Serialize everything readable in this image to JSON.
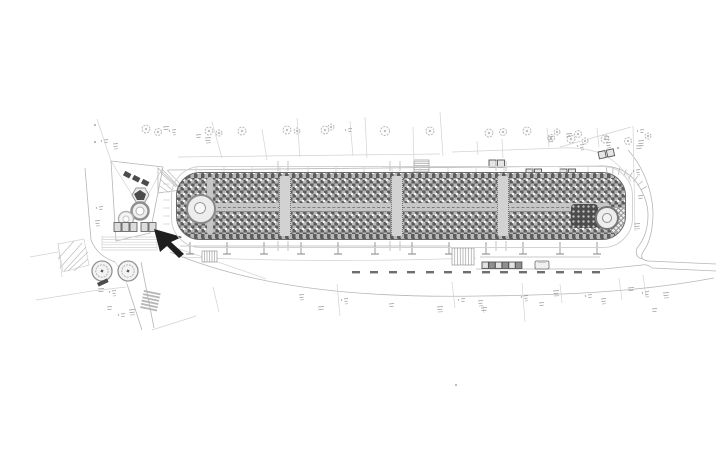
{
  "canvas": {
    "width": 718,
    "height": 450
  },
  "colors": {
    "paper": "#ffffff",
    "faint": "#d2d2d2",
    "line": "#b6b6b6",
    "mid": "#989898",
    "ink": "#6e6e6e",
    "dark": "#4c4c4c",
    "black": "#1f1f1f",
    "fill_light": "#f3f3f3",
    "prom_dark": "#5c5c5c",
    "prom_light": "#b9b9b9",
    "prom_dot": "#f4f4f4",
    "strip_light": "#d2d2d2",
    "band": "#c6c6c6"
  },
  "plan": {
    "promenade": {
      "x": 176,
      "y": 172,
      "w": 450,
      "h": 68,
      "radius": 24,
      "crosswalk_xs": [
        283,
        395,
        501
      ]
    },
    "posts": {
      "y": 242,
      "len": 12,
      "cap": 8,
      "xs": [
        190,
        227,
        264,
        301,
        338,
        375,
        412,
        449,
        486,
        523,
        560,
        597
      ]
    },
    "parking_dashes": {
      "y": 271,
      "w": 8,
      "h": 2.4,
      "xs": [
        352,
        370,
        389,
        407,
        426,
        444,
        463,
        482,
        500,
        519,
        537,
        556,
        574,
        592
      ]
    },
    "street_trees": [
      [
        146,
        129,
        4
      ],
      [
        158,
        132,
        3.5
      ],
      [
        209,
        131,
        4
      ],
      [
        219,
        133,
        3
      ],
      [
        242,
        131,
        4
      ],
      [
        287,
        130,
        4
      ],
      [
        297,
        131,
        3
      ],
      [
        325,
        130,
        4
      ],
      [
        331,
        127,
        3
      ],
      [
        385,
        131,
        4.5
      ],
      [
        430,
        131,
        4
      ],
      [
        489,
        133,
        4
      ],
      [
        503,
        132,
        3.5
      ],
      [
        527,
        131,
        4
      ],
      [
        551,
        138,
        3.5
      ],
      [
        557,
        132,
        3
      ],
      [
        571,
        139,
        4
      ],
      [
        578,
        134,
        3.5
      ],
      [
        585,
        141,
        3
      ],
      [
        605,
        139,
        4
      ],
      [
        628,
        141,
        3.5
      ],
      [
        648,
        136,
        3
      ]
    ],
    "big_trees": [
      [
        102,
        271,
        10
      ],
      [
        128,
        271,
        10
      ]
    ],
    "planter_row": {
      "x": 482,
      "y": 262,
      "n": 6,
      "size": 6.4
    },
    "car": {
      "x": 535,
      "y": 261,
      "w": 14,
      "h": 8
    },
    "shelters": [
      {
        "x": 489,
        "y": 160,
        "rot": 0
      },
      {
        "x": 526,
        "y": 169,
        "rot": 0
      },
      {
        "x": 560,
        "y": 169,
        "rot": 0
      },
      {
        "x": 598,
        "y": 152,
        "rot": -12
      }
    ],
    "stairs": [
      {
        "x": 414,
        "y": 160,
        "w": 15,
        "h": 13,
        "n": 6,
        "dir": "h"
      },
      {
        "x": 452,
        "y": 248,
        "w": 22,
        "h": 17,
        "n": 7,
        "dir": "v"
      },
      {
        "x": 202,
        "y": 251,
        "w": 15,
        "h": 11,
        "n": 5,
        "dir": "v"
      }
    ],
    "zebra": {
      "x": 144,
      "y": 290,
      "w": 17,
      "h": 1.8,
      "n": 6,
      "dy": 3.3,
      "tilt": 12
    },
    "bench": {
      "x": 97,
      "y": 283,
      "w": 11,
      "h": 4,
      "rot": -25
    },
    "fan_ticks": {
      "cx": 612,
      "cy": 208,
      "r1": 34,
      "r2": 41,
      "a0": -98,
      "a1": -32,
      "n": 8
    },
    "edge_ticks": {
      "y1": 167,
      "y2": 172,
      "xs": [
        196,
        224,
        252,
        280,
        308,
        336,
        364,
        392,
        420,
        448,
        476,
        504,
        532,
        560,
        588
      ]
    },
    "left_ticks": {
      "x1": 163,
      "x2": 170,
      "ys": [
        184,
        192,
        200,
        208,
        216,
        224
      ]
    },
    "crosswalk_stubs": {
      "top1": 161,
      "top2": 171,
      "bot1": 241,
      "bot2": 251,
      "offset": 5
    },
    "parcel_lines": [
      [
        212,
        122,
        222,
        158
      ],
      [
        262,
        129,
        267,
        160
      ],
      [
        297,
        118,
        300,
        157
      ],
      [
        350,
        121,
        353,
        156
      ],
      [
        365,
        117,
        367,
        158
      ],
      [
        413,
        127,
        414,
        161
      ],
      [
        440,
        112,
        443,
        156
      ],
      [
        477,
        141,
        478,
        155
      ],
      [
        502,
        139,
        503,
        158
      ],
      [
        547,
        128,
        549,
        147
      ],
      [
        597,
        128,
        599,
        147
      ],
      [
        213,
        287,
        219,
        312
      ],
      [
        337,
        284,
        340,
        316
      ],
      [
        452,
        282,
        455,
        308
      ],
      [
        522,
        283,
        525,
        322
      ],
      [
        560,
        284,
        562,
        303
      ],
      [
        619,
        278,
        622,
        300
      ],
      [
        643,
        275,
        646,
        297
      ],
      [
        483,
        306,
        484,
        313
      ],
      [
        152,
        330,
        196,
        316
      ]
    ],
    "hatch_lines": [
      [
        60,
        268,
        82,
        243
      ],
      [
        64,
        271,
        86,
        247
      ],
      [
        58,
        259,
        74,
        241
      ],
      [
        68,
        271,
        88,
        252
      ],
      [
        74,
        271,
        88,
        259
      ],
      [
        160,
        172,
        176,
        187
      ],
      [
        160,
        179,
        172,
        190
      ],
      [
        160,
        186,
        168,
        192
      ],
      [
        162,
        169,
        180,
        188
      ],
      [
        167,
        170,
        181,
        185
      ]
    ],
    "annotation_clusters": [
      [
        104,
        140
      ],
      [
        113,
        144
      ],
      [
        163,
        127
      ],
      [
        172,
        130
      ],
      [
        196,
        135
      ],
      [
        205,
        138
      ],
      [
        348,
        129
      ],
      [
        548,
        137
      ],
      [
        566,
        134
      ],
      [
        580,
        145
      ],
      [
        604,
        137
      ],
      [
        638,
        141
      ],
      [
        640,
        130
      ],
      [
        606,
        143
      ],
      [
        636,
        146
      ],
      [
        636,
        170
      ],
      [
        638,
        196
      ],
      [
        634,
        224
      ],
      [
        99,
        207
      ],
      [
        95,
        221
      ],
      [
        98,
        289
      ],
      [
        112,
        291
      ],
      [
        107,
        307
      ],
      [
        129,
        310
      ],
      [
        121,
        314
      ],
      [
        299,
        295
      ],
      [
        318,
        307
      ],
      [
        344,
        299
      ],
      [
        389,
        304
      ],
      [
        437,
        307
      ],
      [
        461,
        299
      ],
      [
        478,
        301
      ],
      [
        481,
        308
      ],
      [
        524,
        296
      ],
      [
        539,
        303
      ],
      [
        553,
        291
      ],
      [
        588,
        295
      ],
      [
        601,
        299
      ],
      [
        628,
        288
      ],
      [
        645,
        292
      ],
      [
        652,
        309
      ],
      [
        663,
        293
      ]
    ],
    "dots": [
      [
        95,
        125
      ],
      [
        95,
        142
      ],
      [
        456,
        385
      ],
      [
        618,
        148
      ]
    ]
  }
}
